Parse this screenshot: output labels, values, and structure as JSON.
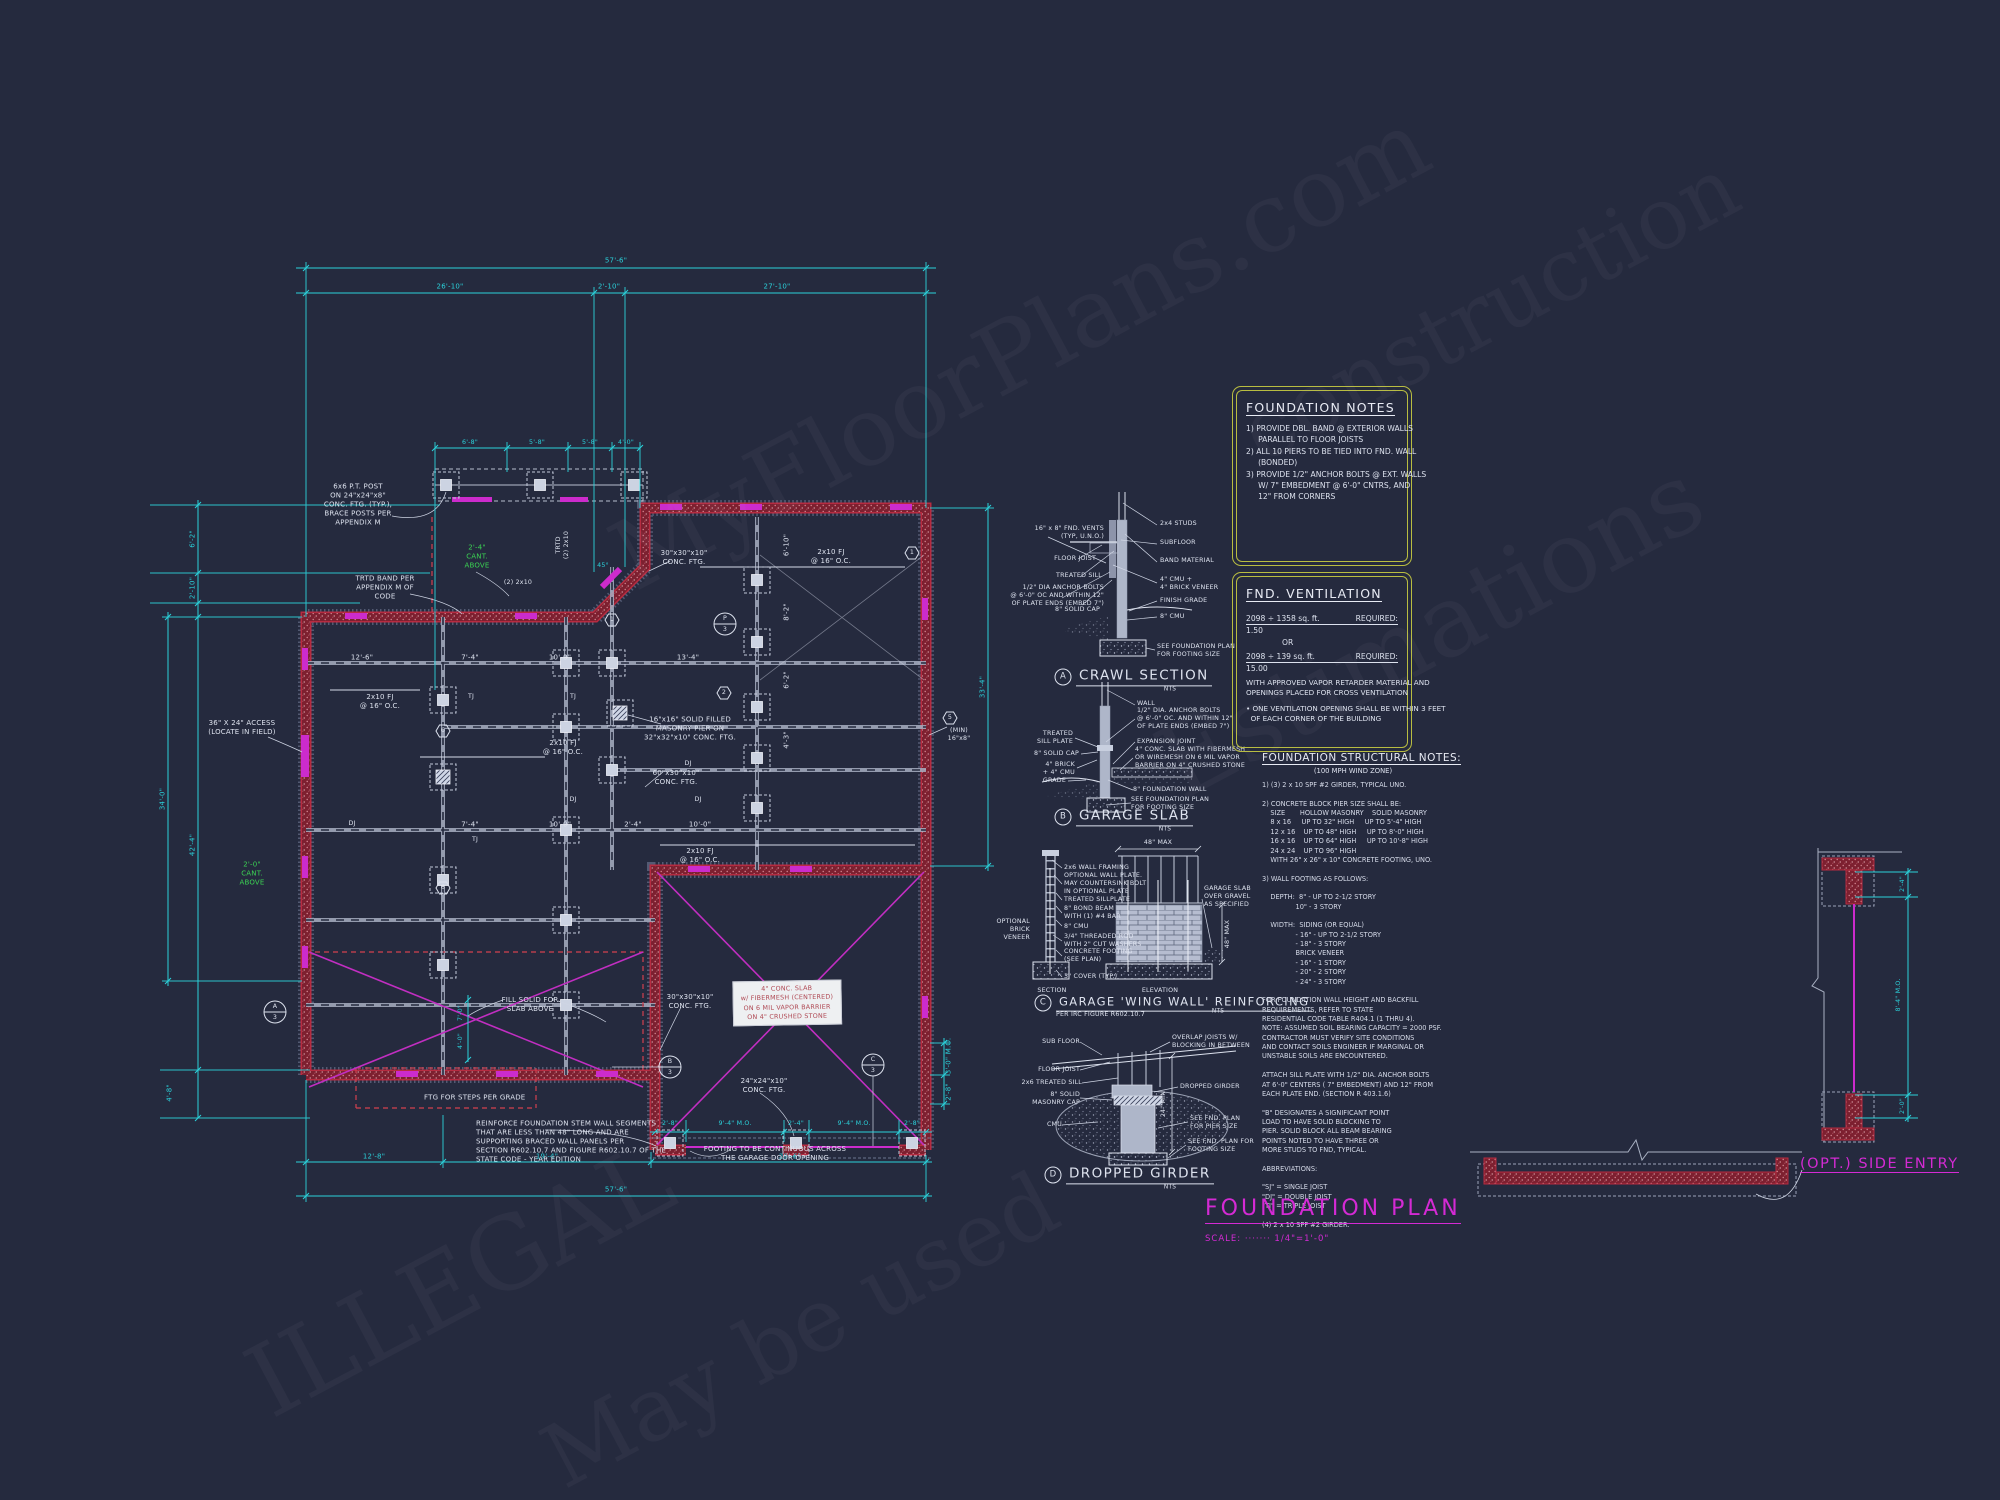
{
  "palette": {
    "background": "#252a3e",
    "dimension_cyan": "#2bd1da",
    "wall_red": "#7d2030",
    "accent_magenta": "#cc2bcc",
    "cant_green": "#3bd253",
    "note_box_yellow": "#b9bd41",
    "line_white": "#dde2ee"
  },
  "title_block": {
    "title": "FOUNDATION PLAN",
    "scale": "SCALE: ·······  1/4\"=1'-0\""
  },
  "watermark": {
    "l0": "MyFloorPlans.com",
    "l1": "construction",
    "l2": "Estimations",
    "l3": "ILLEGAL",
    "l4": "May be used"
  },
  "plan": {
    "cyan": [
      "57'-6\"",
      "26'-10\"",
      "2'-10\"",
      "27'-10\"",
      "6'-2\"",
      "2'-10\"",
      "42'-4\"",
      "4'-8\"",
      "34'-0\"",
      "33'-4\"",
      "3'-0\" M.O.",
      "2'-8\"",
      "2'-8\"",
      "9'-4\" M.O.",
      "2'-4\"",
      "9'-4\" M.O.",
      "2'-8\"",
      "12'-8\"",
      "19'-4\"",
      "29'-6\"",
      "57'-6\"",
      "6'-8\"",
      "5'-8\"",
      "5'-8\"",
      "4'-0\"",
      "7'-0\"",
      "4'-0\"",
      "45°"
    ],
    "white": [
      "12'-6\"",
      "7'-4\"",
      "10'-0\"",
      "13'-4\"",
      "7'-4\"",
      "10'-0\"",
      "2'-4\"",
      "10'-0\"",
      "6'-10\"",
      "8'-2\"",
      "6'-2\"",
      "4'-3\""
    ],
    "labels": {
      "post_note": "6x6 P.T. POST\nON 24\"x24\"x8\"\nCONC. FTG. (TYP.),\nBRACE POSTS PER\nAPPENDIX M",
      "trtd_band": "TRTD BAND PER\nAPPENDIX M OF\nCODE",
      "cant_a": "2'-4\"\nCANT.\nABOVE",
      "cant_b": "2'-0\"\nCANT.\nABOVE",
      "access": "36\" X 24\" ACCESS\n(LOCATE IN FIELD)",
      "fj": "2x10 FJ\n@ 16\" O.C.",
      "pier": "16\"x16\" SOLID FILLED\nMASONRY PIER ON\n32\"x32\"x10\" CONC. FTG.",
      "ftg30": "30\"x30\"x10\"\nCONC. FTG.",
      "ftg60": "60\"x30\"x10\"\nCONC. FTG.",
      "ftg24": "24\"x24\"x10\"\nCONC. FTG.",
      "fill_solid": "FILL SOLID FOR\nSLAB ABOVE",
      "ftg_steps": "FTG FOR STEPS PER GRADE",
      "reinforce": "REINFORCE FOUNDATION STEM WALL SEGMENTS\nTHAT ARE LESS THAN 48\" LONG AND ARE\nSUPPORTING BRACED WALL PANELS PER\nSECTION R602.10.7 AND FIGURE R602.10.7 OF THE\nSTATE CODE - YEAR EDITION",
      "footing_cont": "FOOTING TO BE CONTINUOUS ACROSS\nTHE GARAGE DOOR OPENING",
      "min_vent": "(MIN)\n16\"x8\"",
      "trtd_deck": "TRTD\n(2) 2x10",
      "deck_hdr": "(2) 2x10",
      "slab_note": "4\" CONC. SLAB\nw/ FIBERMESH (CENTERED)\nON 6 MIL VAPOR BARRIER\nON 4\" CRUSHED STONE",
      "dj": "DJ",
      "tj": "TJ"
    },
    "markers": {
      "hex": [
        "1",
        "2",
        "5",
        "6",
        "6",
        "1"
      ],
      "p": "P",
      "a": "A",
      "b": "B",
      "c": "C",
      "sheet": "3"
    }
  },
  "details": {
    "crawl": {
      "letter": "A",
      "title": "CRAWL SECTION",
      "nts": "NTS",
      "l0": "16\" x 8\" FND. VENTS\n(TYP, U.N.O.)",
      "l1": "FLOOR JOIST",
      "l2": "TREATED SILL",
      "l3": "1/2\" DIA ANCHOR BOLTS\n@ 6'-0\" OC AND WITHIN 12\"\nOF PLATE ENDS (EMBED 7\")",
      "l4": "8\" SOLID CAP",
      "r0": "2x4 STUDS",
      "r1": "SUBFLOOR",
      "r2": "BAND MATERIAL",
      "r3": "4\" CMU +\n4\" BRICK VENEER",
      "r4": "FINISH GRADE",
      "r5": "8\" CMU",
      "r6": "SEE FOUNDATION PLAN\nFOR FOOTING SIZE"
    },
    "slab": {
      "letter": "B",
      "title": "GARAGE SLAB",
      "nts": "NTS",
      "l0": "TREATED\nSILL PLATE",
      "l1": "8\" SOLID CAP",
      "l2": "4\" BRICK\n+ 4\" CMU",
      "l3": "GRADE",
      "r0": "WALL",
      "r1": "1/2\" DIA. ANCHOR BOLTS\n@ 6'-0\" OC. AND WITHIN 12\"\nOF PLATE ENDS (EMBED 7\")",
      "r2": "EXPANSION JOINT",
      "r3": "4\" CONC. SLAB WITH FIBERMESH\nOR WIREMESH ON 6 MIL VAPOR\nBARRIER ON 4\" CRUSHED STONE",
      "r4": "8\" FOUNDATION WALL",
      "r5": "SEE FOUNDATION PLAN\nFOR FOOTING SIZE"
    },
    "wing": {
      "letter": "C",
      "title": "GARAGE 'WING WALL' REINFORCING",
      "sub": "PER IRC FIGURE R602.10.7",
      "nts": "NTS",
      "l0": "2x6 WALL FRAMING",
      "l1": "OPTIONAL WALL PLATE.\nMAY COUNTERSINK BOLT\nIN OPTIONAL PLATE",
      "l2": "TREATED SILLPLATE",
      "l3": "8\" BOND BEAM\nWITH (1) #4 BAR",
      "l4": "8\" CMU",
      "l5": "3/4\" THREADED ROD\nWITH 2\" CUT WASHERS",
      "l6": "CONCRETE FOOTING\n(SEE PLAN)",
      "l7": "3\" COVER (TYP.)",
      "r0": "GARAGE SLAB\nOVER GRAVEL\nAS SPECIFIED",
      "side": "OPTIONAL\nBRICK\nVENEER",
      "d0": "48\" MAX",
      "d1": "48\" MAX",
      "c0": "SECTION",
      "c1": "ELEVATION"
    },
    "girder": {
      "letter": "D",
      "title": "DROPPED GIRDER",
      "nts": "NTS",
      "l0": "SUB FLOOR",
      "l1": "FLOOR JOIST",
      "l2": "2x6 TREATED SILL",
      "l3": "8\" SOLID\nMASONRY CAP",
      "l4": "CMU",
      "r0": "OVERLAP JOISTS W/\nBLOCKING IN BETWEEN",
      "r1": "DROPPED GIRDER",
      "r2": "SEE FND. PLAN\nFOR PIER SIZE",
      "r3": "SEE FND. PLAN FOR\nFOOTING SIZE",
      "dim": "24\" MIN"
    }
  },
  "notes": {
    "found": {
      "title": "FOUNDATION NOTES",
      "body": "1) PROVIDE DBL. BAND @ EXTERIOR WALLS\n     PARALLEL TO FLOOR JOISTS\n2) ALL 10 PIERS TO BE TIED INTO FND. WALL\n     (BONDED)\n3) PROVIDE 1/2\" ANCHOR BOLTS @ EXT. WALLS\n     W/ 7\" EMBEDMENT @ 6'-0\" CNTRS, AND\n     12\" FROM CORNERS"
    },
    "vent": {
      "title": "FND. VENTILATION",
      "r1l": "2098 ÷ 1358 sq. ft.",
      "r1r": "REQUIRED:",
      "v1": "1.50",
      "or": "OR",
      "r2l": "2098 ÷ 139 sq. ft.",
      "r2r": "REQUIRED:",
      "v2": "15.00",
      "para": "WITH APPROVED VAPOR RETARDER MATERIAL AND\nOPENINGS PLACED FOR CROSS VENTILATION",
      "bullet": "• ONE VENTILATION OPENING SHALL BE WITHIN 3 FEET\n  OF EACH CORNER OF THE BUILDING"
    },
    "struct": {
      "title": "FOUNDATION STRUCTURAL NOTES:",
      "sub": "(100 MPH WIND ZONE)",
      "body": "1) (3) 2 x 10 SPF #2 GIRDER, TYPICAL UNO.\n\n2) CONCRETE BLOCK PIER SIZE SHALL BE:\n    SIZE       HOLLOW MASONRY    SOLID MASONRY\n    8 x 16     UP TO 32\" HIGH     UP TO 5'-4\" HIGH\n    12 x 16    UP TO 48\" HIGH     UP TO 8'-0\" HIGH\n    16 x 16    UP TO 64\" HIGH     UP TO 10'-8\" HIGH\n    24 x 24    UP TO 96\" HIGH\n    WITH 26\" x 26\" x 10\" CONCRETE FOOTING, UNO.\n\n3) WALL FOOTING AS FOLLOWS:\n\n    DEPTH:  8\" - UP TO 2-1/2 STORY\n                10\" - 3 STORY\n\n    WIDTH:  SIDING (OR EQUAL)\n                - 16\" - UP TO 2-1/2 STORY\n                - 18\" - 3 STORY\n                BRICK VENEER\n                - 16\" - 1 STORY\n                - 20\" - 2 STORY\n                - 24\" - 3 STORY\n\nFOR FOUNDATION WALL HEIGHT AND BACKFILL\nREQUIREMENTS, REFER TO STATE\nRESIDENTIAL CODE TABLE R404.1 (1 THRU 4).\nNOTE: ASSUMED SOIL BEARING CAPACITY = 2000 PSF.\nCONTRACTOR MUST VERIFY SITE CONDITIONS\nAND CONTACT SOILS ENGINEER IF MARGINAL OR\nUNSTABLE SOILS ARE ENCOUNTERED.\n\nATTACH SILL PLATE WITH 1/2\" DIA. ANCHOR BOLTS\nAT 6'-0\" CENTERS ( 7\" EMBEDMENT) AND 12\" FROM\nEACH PLATE END. (SECTION R 403.1.6)\n\n\"B\" DESIGNATES A SIGNIFICANT POINT\nLOAD TO HAVE SOLID BLOCKING TO\nPIER. SOLID BLOCK ALL BEAM BEARING\nPOINTS NOTED TO HAVE THREE OR\nMORE STUDS TO FND, TYPICAL.\n\nABBREVIATIONS:\n\n\"SJ\" = SINGLE JOIST\n\"DJ\" = DOUBLE JOIST\n\"TJ\" = TRIPLE JOIST\n\n(4) 2 x 10 SPF #2 GIRDER."
    }
  },
  "side_entry": {
    "label": "(OPT.) SIDE ENTRY",
    "d0": "2'-4\"",
    "d1": "8'-4\" M.O.",
    "d2": "2'-0\""
  }
}
